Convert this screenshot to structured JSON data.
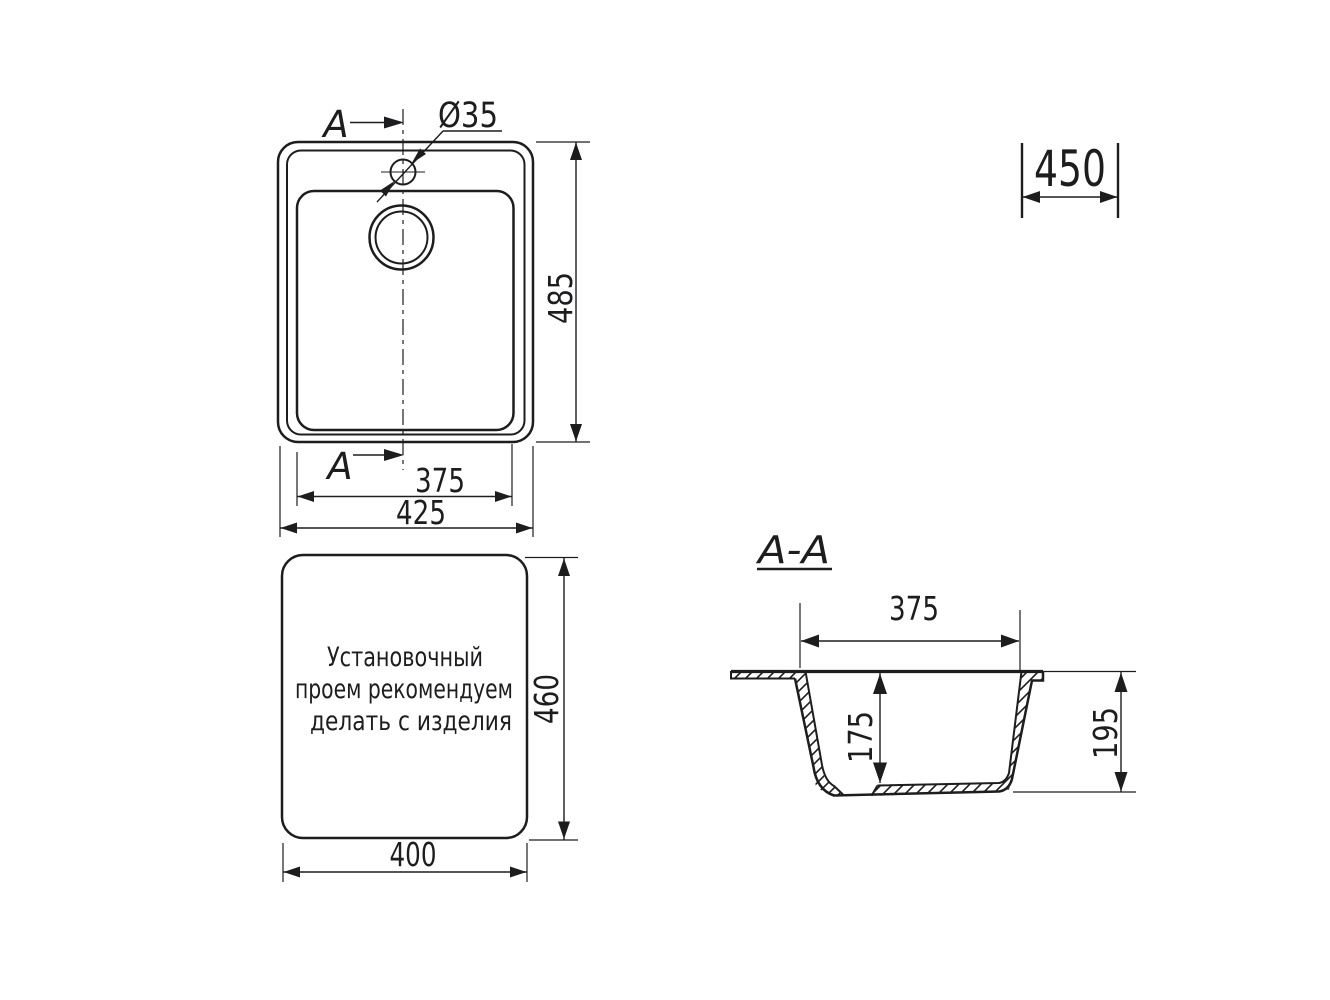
{
  "colors": {
    "ink": "#1d1d1f",
    "paper": "#ffffff"
  },
  "top_view": {
    "section_label": "A",
    "hole_label": "Ø35",
    "dim_depth": "485",
    "dim_bowl_width": "375",
    "dim_overall_width": "425"
  },
  "cabinet": {
    "dim_min_base_width": "450"
  },
  "cutout": {
    "note_line_1": "Установочный",
    "note_line_2": "проем рекомендуем",
    "note_line_3": "делать с изделия",
    "dim_height": "460",
    "dim_width": "400"
  },
  "section": {
    "title": "A-A",
    "dim_opening_width": "375",
    "dim_bowl_depth": "175",
    "dim_overall_depth": "195"
  }
}
